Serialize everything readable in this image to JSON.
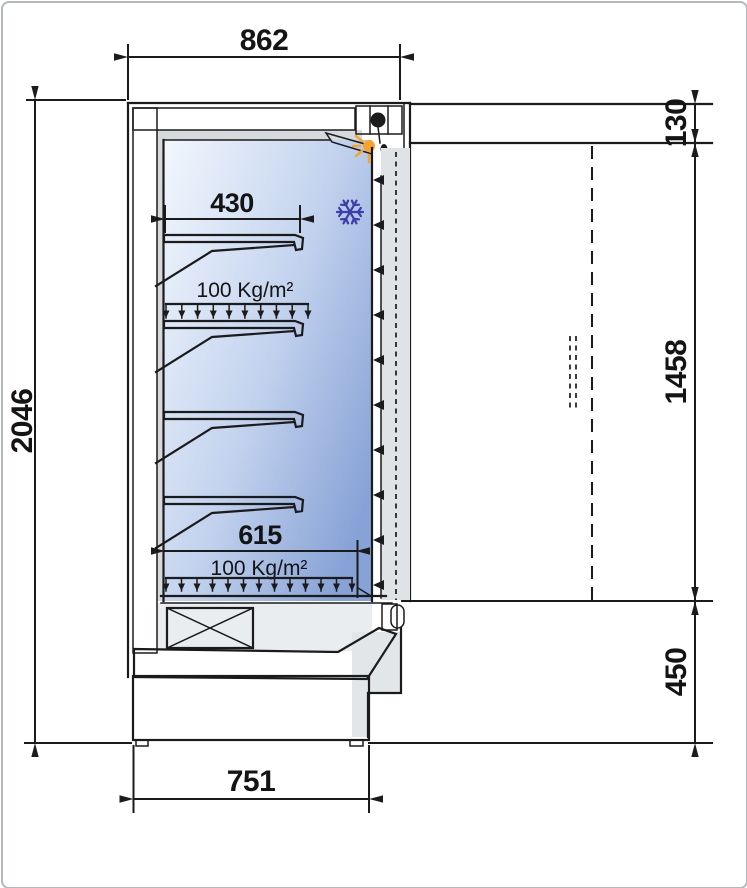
{
  "dims": {
    "overall_width": "862",
    "overall_height": "2046",
    "canopy_height": "130",
    "opening_height": "1458",
    "base_height": "450",
    "base_depth": "751",
    "shelf_depth": "430",
    "deck_depth": "615"
  },
  "labels": {
    "shelf_load": "100 Kg/m²",
    "deck_load": "100 Kg/m²"
  },
  "colors": {
    "line": "#1b1b1b",
    "interior_light": "#f2f7fd",
    "interior_mid": "#c2d2ee",
    "interior_dark": "#87a2d6",
    "lamp_orange": "#f7a428",
    "snowflake_blue": "#3c3caa",
    "panel_gray": "#dfe3e6",
    "hatch_bg": "#e9ebe9"
  }
}
